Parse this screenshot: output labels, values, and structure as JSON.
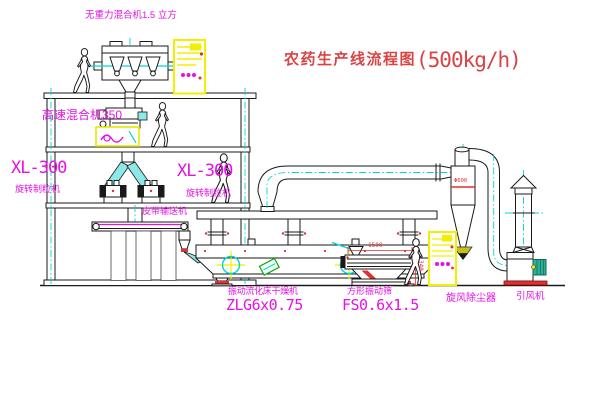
{
  "title": {
    "zh": "农药生产线流程图",
    "qty": "(500kg/h)"
  },
  "labels": {
    "gravity_mixer": "无重力混合机1.5 立方",
    "high_speed_mixer": "高速混合机350",
    "granulator_model_left": "XL-300",
    "granulator_left": "旋转制粒机",
    "granulator_model_mid": "XL-300",
    "granulator_mid": "旋转制粒机",
    "belt_conveyor": "皮带输送机",
    "dryer": "振动流化床干燥机",
    "dryer_model": "ZLG6x0.75",
    "sieve": "方形振动筛",
    "sieve_model": "FS0.6x1.5",
    "cyclone": "旋风除尘器",
    "fan": "引风机"
  },
  "dimensions": {
    "sieve_length": "1500",
    "sieve_height": "340",
    "cyclone_diameter": "Φ600"
  },
  "colors": {
    "label_magenta": "#e511e5",
    "title_red": "#d94444",
    "dimension_red": "#e03030",
    "pipe_cyan": "#00d5d5",
    "cabinet_yellow": "#f0f000"
  }
}
